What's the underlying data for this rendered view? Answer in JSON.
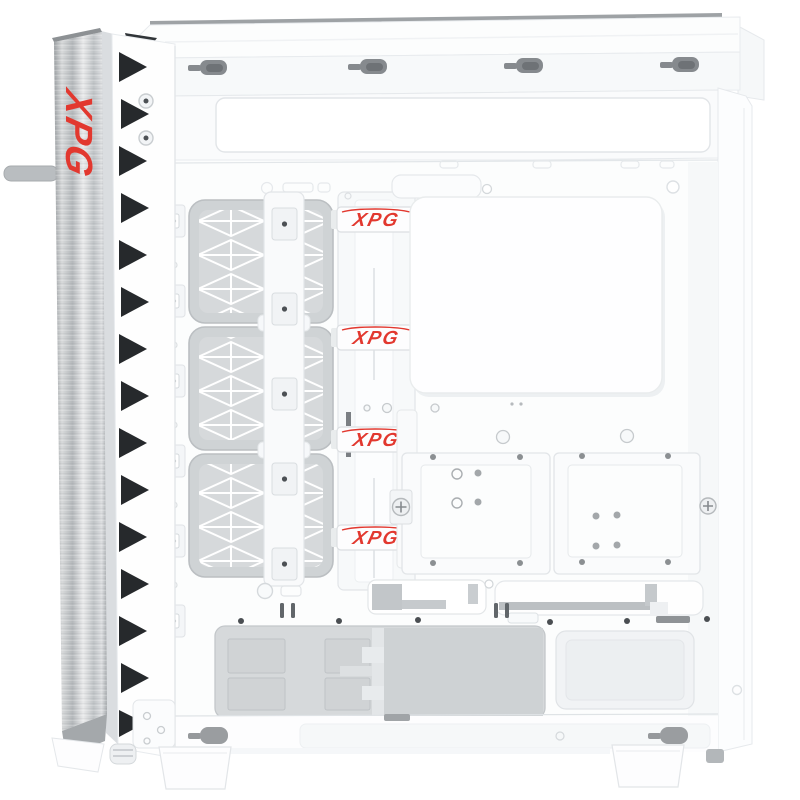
{
  "image": {
    "description": "White XPG mid-tower PC case, left side panel removed, empty interior product photo",
    "background": "#ffffff"
  },
  "brand": {
    "name": "XPG",
    "logo_color": "#e2382f"
  },
  "front_trim": {
    "logo_text": "XPG"
  },
  "cable_straps": {
    "labels": [
      "XPG",
      "XPG",
      "XPG",
      "XPG"
    ]
  },
  "palette": {
    "case_white": "#fdfdfe",
    "line_gray": "#e2e5e8",
    "filter_gray": "#d6d9db",
    "chamber_gray": "#d4d7d9",
    "hardware_gray": "#86898d",
    "vent_black": "#26292c",
    "aluminum_light": "#e9eaeb",
    "aluminum_dark": "#9ea2a5"
  }
}
